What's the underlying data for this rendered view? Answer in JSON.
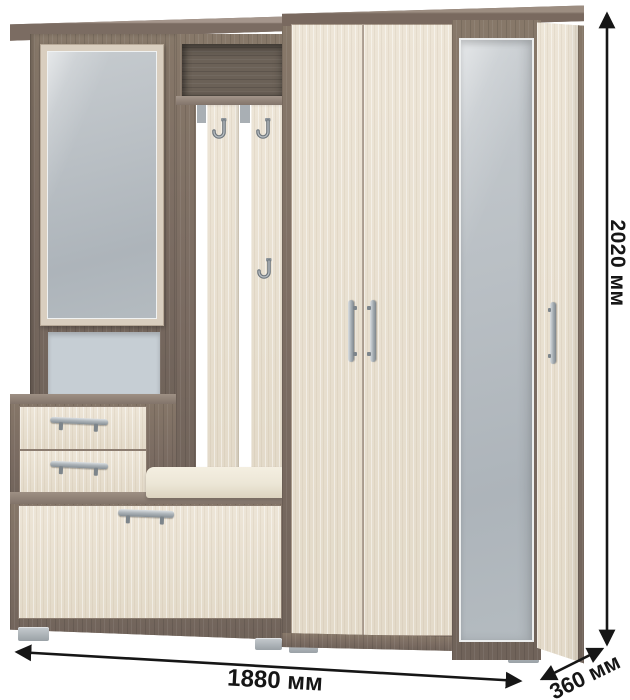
{
  "page": {
    "background": "#ffffff",
    "subject": "hallway furniture set with mirror, coat hooks, drawers, bench and wardrobe"
  },
  "dimensions": {
    "height": {
      "label": "2020 мм",
      "orientation": "vertical-right"
    },
    "width": {
      "label": "1880 мм",
      "orientation": "horizontal-bottom"
    },
    "depth": {
      "label": "360 мм",
      "orientation": "diagonal-bottom-right"
    }
  },
  "palette": {
    "dark_wood": "#7d6e64",
    "light_wood": "#e9e1d2",
    "mirror_gray": "#b8bec3",
    "recess_panel": "#c6ced4",
    "cushion": "#efe9da",
    "metal": "#9aa1a7",
    "annotation": "#161616"
  }
}
